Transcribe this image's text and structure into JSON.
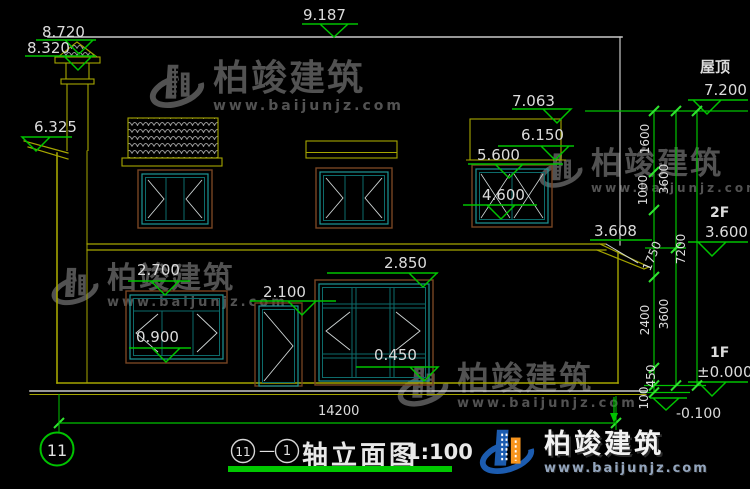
{
  "drawing": {
    "elevations": {
      "e9187": "9.187",
      "e8720": "8.720",
      "e8320": "8.320",
      "e7063": "7.063",
      "e6325": "6.325",
      "e6150": "6.150",
      "e5600": "5.600",
      "e4600": "4.600",
      "e3608": "3.608",
      "e2850": "2.850",
      "e2700": "2.700",
      "e2100": "2.100",
      "e0900": "0.900",
      "e0450": "0.450"
    },
    "vertical_dims": {
      "chain1": [
        "1600",
        "1000",
        "1750",
        "2400",
        "450",
        "100"
      ],
      "chain2": [
        "3600",
        "3600"
      ],
      "chain3": [
        "7200"
      ]
    },
    "levels": {
      "roof_label": "屋顶",
      "roof_value": "7.200",
      "f2_label": "2F",
      "f2_value": "3.600",
      "f1_label": "1F",
      "f1_value": "±0.000",
      "ground_value": "-0.100"
    },
    "total_width": "14200",
    "axis_bubble": "11"
  },
  "title_block": {
    "axis_start": "11",
    "separator": "—",
    "axis_end": "1",
    "name": "轴立面图",
    "scale": "1:100"
  },
  "watermark": {
    "brand": "柏竣建筑",
    "url": "www.baijunjz.com"
  },
  "logo": {
    "brand": "柏竣建筑",
    "url": "www.baijunjz.com"
  }
}
